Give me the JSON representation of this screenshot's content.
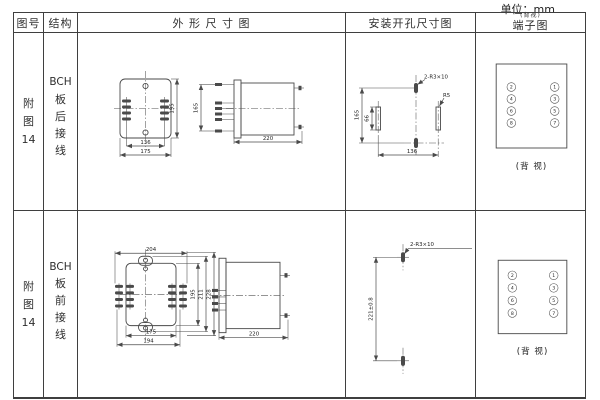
{
  "page": {
    "unit_label": "单位：mm"
  },
  "header": {
    "fig_no": "图号",
    "structure": "结构",
    "outline": "外 形 尺 寸 图",
    "mounting": "安装开孔尺寸图",
    "terminal": "端子图",
    "terminal_note": "(背视)"
  },
  "rows": [
    {
      "fig_no": [
        "附",
        "图",
        "14"
      ],
      "structure": [
        "BCH",
        "板",
        "后",
        "接",
        "线"
      ],
      "outline": {
        "inner_width": "136",
        "outer_width": "175",
        "height": "195",
        "side_span": "165",
        "depth": "220"
      },
      "mounting": {
        "slot_label": "2-R3×10",
        "radius_label": "R5",
        "v_span": "165",
        "slot_len": "66",
        "h_span": "136"
      },
      "terminal": {
        "left": [
          "2",
          "4",
          "6",
          "8"
        ],
        "right": [
          "1",
          "3",
          "5",
          "7"
        ],
        "caption": "(背 视)"
      }
    },
    {
      "fig_no": [
        "附",
        "图",
        "14"
      ],
      "structure": [
        "BCH",
        "板",
        "前",
        "接",
        "线"
      ],
      "outline": {
        "top_width": "204",
        "inner_width": "175",
        "outer_width": "194",
        "height": "195",
        "mid_height": "211",
        "outer_height": "228",
        "depth": "220"
      },
      "mounting": {
        "slot_label": "2-R3×10",
        "v_span": "221±0.8"
      },
      "terminal": {
        "left": [
          "2",
          "4",
          "6",
          "8"
        ],
        "right": [
          "1",
          "3",
          "5",
          "7"
        ],
        "caption": "(背 视)"
      }
    }
  ]
}
